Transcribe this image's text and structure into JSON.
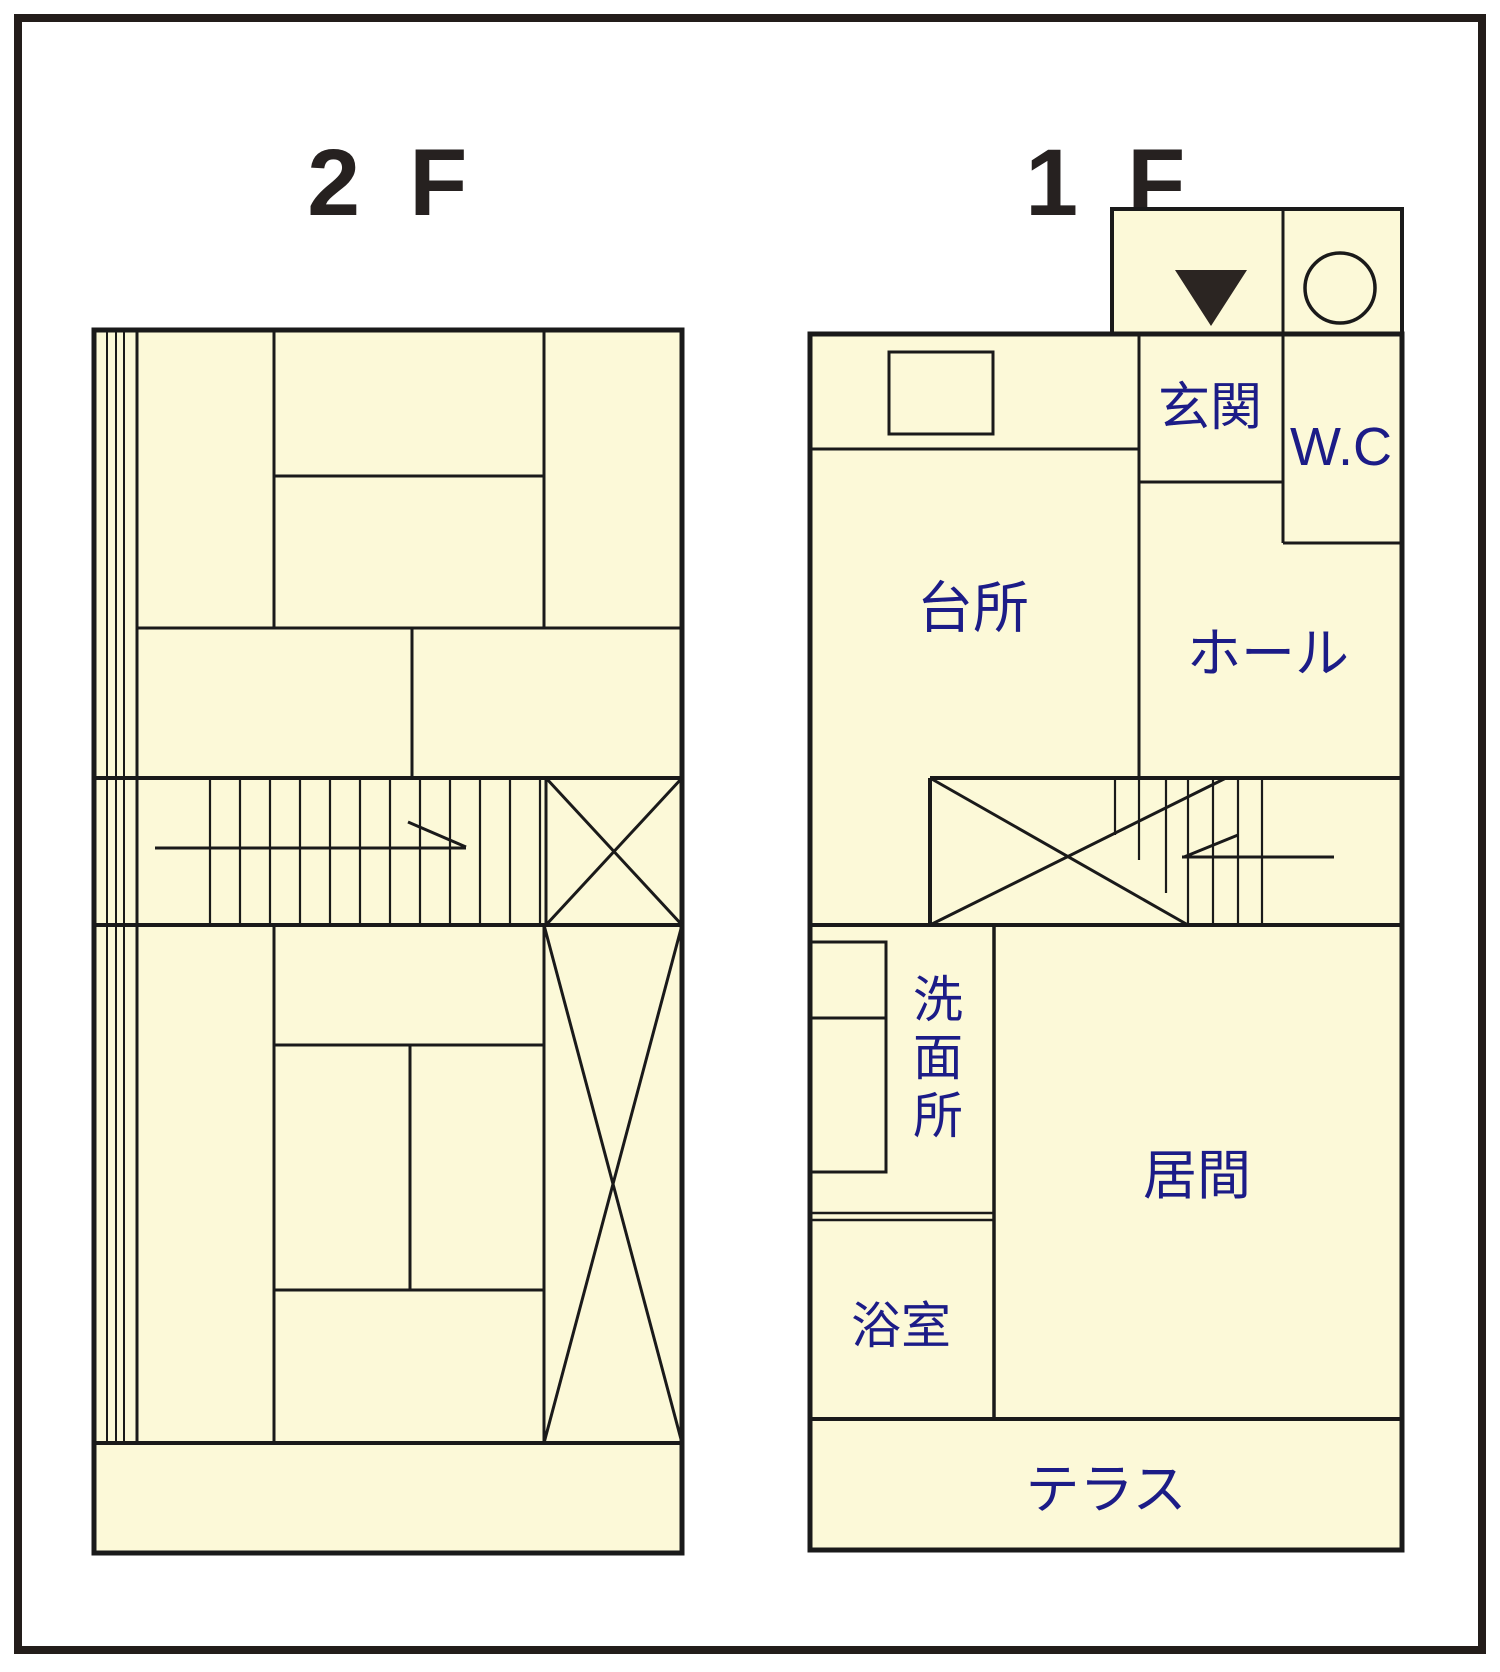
{
  "titles": {
    "floor2": "2 F",
    "floor1": "1 F"
  },
  "floor1": {
    "rooms": {
      "genkan": "玄関",
      "wc": "W.C",
      "kitchen": "台所",
      "hall": "ホール",
      "washroom": "洗面所",
      "washroom_chars": [
        "洗",
        "面",
        "所"
      ],
      "living": "居間",
      "bath": "浴室",
      "terrace": "テラス"
    }
  },
  "floor2": {
    "rooms": {}
  },
  "icons": {
    "entrance_triangle": "entrance-direction-marker",
    "porch_circle": "porch-circle-symbol"
  },
  "colors": {
    "floor_fill": "#fcf9d8",
    "wall": "#1a1a1a",
    "room_label": "#1c1c87",
    "title": "#262120",
    "marker": "#2b2522",
    "page_bg": "#ffffff",
    "border": "#231d1a"
  }
}
